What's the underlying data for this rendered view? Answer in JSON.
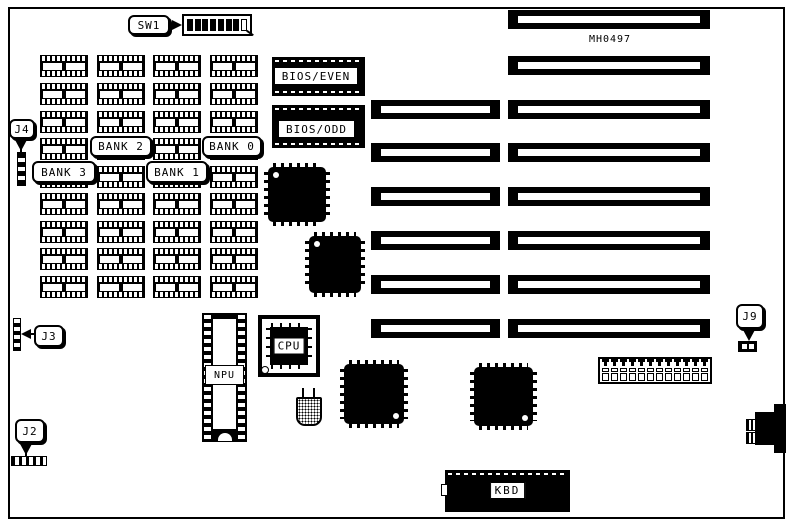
{
  "board": {
    "id_text": "MH0497",
    "line_color": "#000000",
    "background_color": "#ffffff"
  },
  "switch_block": {
    "label": "SW1",
    "positions": [
      "on",
      "on",
      "on",
      "on",
      "on",
      "on",
      "on",
      "off"
    ]
  },
  "memory": {
    "columns": 4,
    "rows": 9,
    "banks": [
      {
        "label": "BANK 2"
      },
      {
        "label": "BANK 0"
      },
      {
        "label": "BANK 3"
      },
      {
        "label": "BANK 1"
      }
    ]
  },
  "jumpers": {
    "j4": {
      "label": "J4"
    },
    "j3": {
      "label": "J3"
    },
    "j2": {
      "label": "J2"
    },
    "j9": {
      "label": "J9",
      "cells": 2
    }
  },
  "chips": {
    "bios_even": {
      "label": "BIOS/EVEN"
    },
    "bios_odd": {
      "label": "BIOS/ODD"
    },
    "npu": {
      "label": "NPU"
    },
    "cpu": {
      "label": "CPU"
    },
    "kbd": {
      "label": "KBD"
    },
    "qfp_count": 4
  },
  "slots": {
    "total": 8,
    "sixteen_bit_rows": [
      3,
      4,
      5,
      6,
      7,
      8
    ]
  },
  "power_connector": {
    "pins": 12
  }
}
